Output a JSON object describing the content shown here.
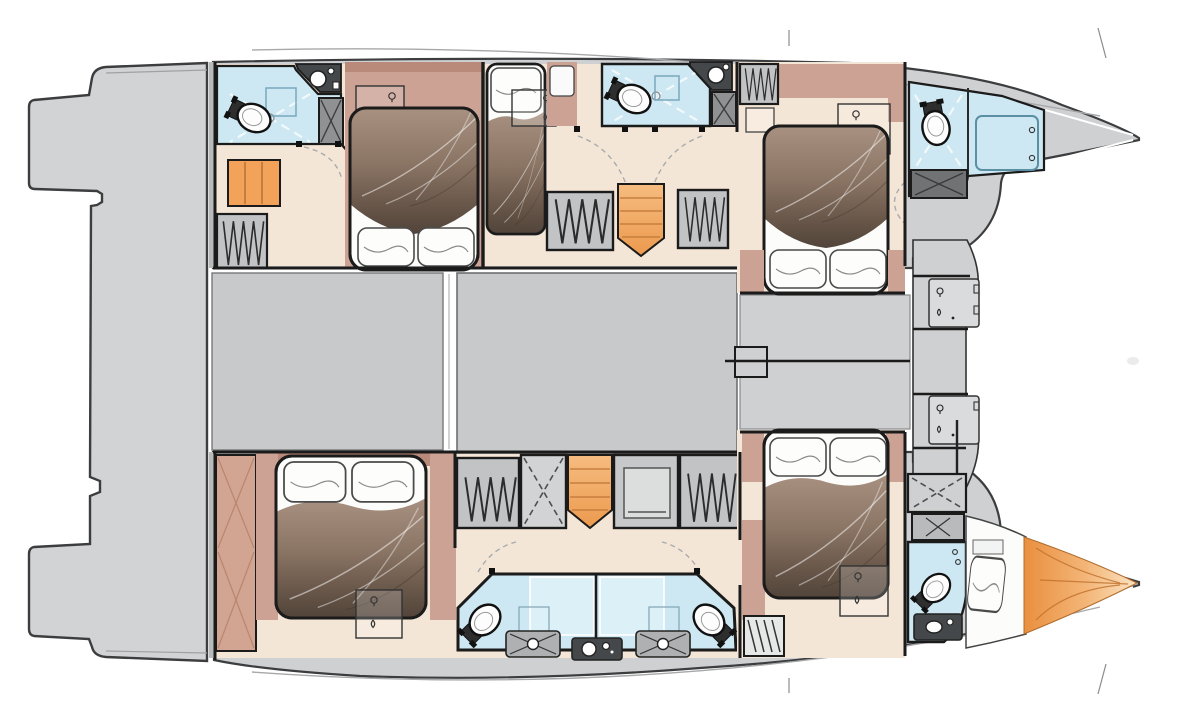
{
  "meta": {
    "description": "Top-down interior deck plan of a sailing catamaran, bows pointing right, no text labels rendered",
    "diagram_kind": "yacht floor plan"
  },
  "colors": {
    "wall": "#1b1b1b",
    "hull_edge": "#3c3d3e",
    "platform": "#d2d3d4",
    "deck": "#cfd0d1",
    "saloon": "#c8c9cb",
    "floor": "#f4e6d6",
    "mauve": "#cba294",
    "mauve_dark": "#b98a7a",
    "wood": "#d2a492",
    "blue": "#cde8f2",
    "blue_panel": "#dcf0f8",
    "counter": "#45484b",
    "cabinet": "#8f9193",
    "locker": "#c2c3c5",
    "locker_light": "#e6e7e7",
    "orange": "#f2a259",
    "orange_deep": "#ec9a4e",
    "sheet": "#fcfcfb",
    "arc": "#a9abad",
    "shower_line": "#f4fafc",
    "bed_gradient_top": "#a89181",
    "bed_gradient_bottom": "#52443a",
    "bow_orange_dark": "#ea8f3f",
    "bow_orange_light": "#fbe2c0"
  },
  "diagram_data": {
    "type": "floorplan",
    "vessel": "catamaran",
    "orientation": "bows-right",
    "zones": {
      "center": [
        "aft-platform",
        "aft-cockpit",
        "saloon",
        "foredeck",
        "bow-locker-top",
        "bow-locker-bottom"
      ],
      "starboard_hull_top": [
        {
          "room": "aft-head",
          "fixtures": [
            "toilet",
            "shower",
            "washbasin",
            "cabinet",
            "wardrobe",
            "orange-cabinet"
          ]
        },
        {
          "room": "aft-double-cabin",
          "fixtures": [
            "double-bed",
            "vanity"
          ]
        },
        {
          "room": "mid-single-cabin",
          "fixtures": [
            "single-bed",
            "desk",
            "nightstand"
          ]
        },
        {
          "room": "mid-head",
          "fixtures": [
            "toilet",
            "shower",
            "washbasin",
            "cabinet"
          ]
        },
        {
          "room": "companionway",
          "fixtures": [
            "steps",
            "hanging-locker",
            "hanging-locker"
          ]
        },
        {
          "room": "forward-double-cabin",
          "fixtures": [
            "double-bed",
            "desk",
            "hanging-locker",
            "nightstand"
          ]
        },
        {
          "room": "bow-head",
          "fixtures": [
            "toilet",
            "shower",
            "cabinet"
          ]
        }
      ],
      "port_hull_bottom": [
        {
          "room": "aft-double-cabin",
          "fixtures": [
            "double-bed",
            "wood-wardrobe",
            "vanity"
          ]
        },
        {
          "room": "companionway",
          "fixtures": [
            "steps",
            "hanging-locker",
            "hanging-locker",
            "x-locker",
            "washing-machine"
          ]
        },
        {
          "room": "twin-heads",
          "fixtures": [
            "toilet",
            "toilet",
            "washbasin",
            "washbasin",
            "shared-counter"
          ]
        },
        {
          "room": "forward-double-cabin",
          "fixtures": [
            "double-bed",
            "desk",
            "ladder"
          ]
        },
        {
          "room": "forward-head",
          "fixtures": [
            "toilet",
            "washbasin",
            "shower",
            "cabinet"
          ]
        },
        {
          "room": "bow-crew-berth",
          "fixtures": [
            "single-berth",
            "pillow",
            "orange-blanket"
          ]
        }
      ]
    },
    "counts": {
      "cabins": 5,
      "crew_berths": 1,
      "heads": 6,
      "saloon": 1
    }
  }
}
